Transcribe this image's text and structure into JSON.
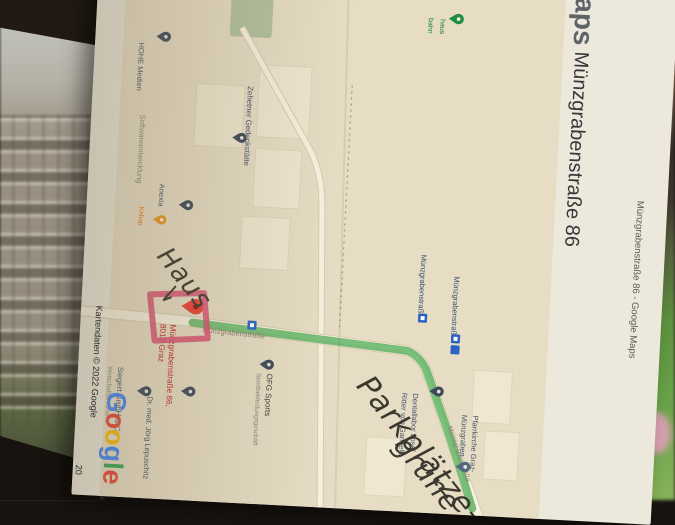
{
  "page": {
    "maps_wordmark": "Maps",
    "header": "Münzgrabenstraße 86 - Google Maps",
    "title": "Münzgrabenstraße 86",
    "subtitle": "Parkgelegenheit",
    "attribution": "Kartendaten © 2022 Google",
    "attribution_fragment": "20"
  },
  "map": {
    "street": {
      "label1": "Münzgrabenstraße",
      "label2": "Münzgrabenstraße"
    },
    "transit": {
      "stop1": "Münzgrabenstraße",
      "stop2": "Münzgrabenstraße"
    },
    "destination": {
      "line1": "Münzgrabenstraße 86,",
      "line2": "8010 Graz",
      "color": "#c5221f"
    },
    "pois": [
      {
        "name": "HOHE Medien",
        "color": "#47536a"
      },
      {
        "name": "Softwareentwicklung",
        "color": "#85887f"
      },
      {
        "name": "Anexia",
        "color": "#47536a"
      },
      {
        "name": "Kebap",
        "color": "#e8710a"
      },
      {
        "name": "Zehetner Gedenkstätte",
        "color": "#47536a"
      },
      {
        "name": "OFG Sports",
        "sub": "Sportbekleidungsgeschäft",
        "color": "#3c4043"
      },
      {
        "name": "Dentallabor Josef",
        "sub": "Ritter von Gandella",
        "color": "#47536a"
      },
      {
        "name": "Pfarrkirche Graz-",
        "sub": "Münzgraben",
        "color": "#47536a"
      },
      {
        "name": "Siegert GmbH & Co",
        "sub": "Wirtschaftstreuhand",
        "color": "#47536a"
      },
      {
        "name": "Dr. med. Jörg Lepuschitz",
        "color": "#47536a"
      },
      {
        "name": "haus",
        "sub": "bahn",
        "color": "#188038"
      }
    ],
    "google_logo": [
      {
        "ch": "G",
        "color": "#4285F4"
      },
      {
        "ch": "o",
        "color": "#EA4335"
      },
      {
        "ch": "o",
        "color": "#FBBC05"
      },
      {
        "ch": "g",
        "color": "#4285F4"
      },
      {
        "ch": "l",
        "color": "#34A853"
      },
      {
        "ch": "e",
        "color": "#EA4335"
      }
    ]
  },
  "annotations": {
    "haus": "Haus",
    "parking_line1": "Parkplätze",
    "parking_line2": "grüne Z"
  },
  "colors": {
    "route_green": "#55ad5a",
    "hand_red": "#d94f72",
    "hand_ink": "#3b382f",
    "map_bg": "#e7ddc5",
    "paper": "#ece8dc",
    "pin_red": "#EA4335",
    "transit_blue": "#2a62c4"
  }
}
